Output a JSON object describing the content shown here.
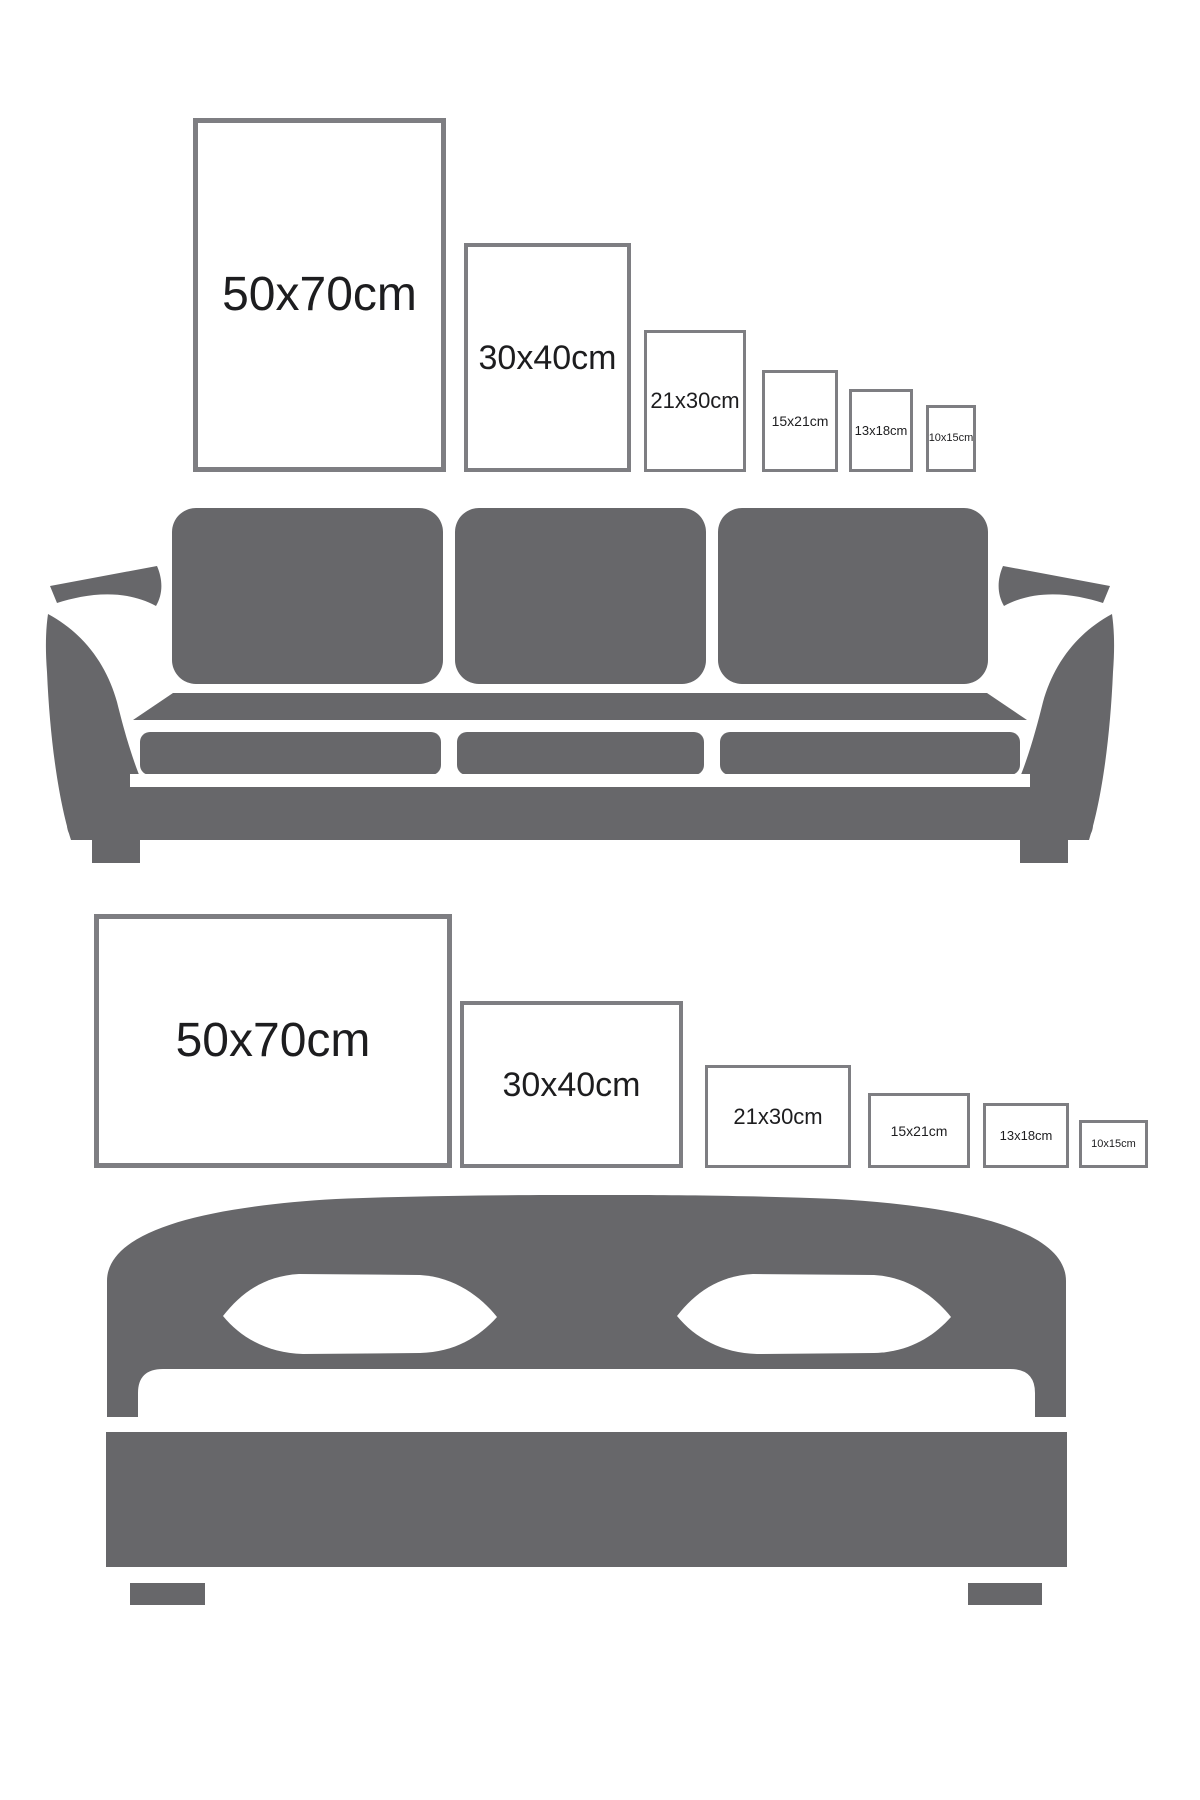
{
  "colors": {
    "background": "#ffffff",
    "furniture_gray": "#67676a",
    "frame_border": "#7e7e82",
    "label_text": "#1d1d1f"
  },
  "sections": [
    {
      "furniture": "sofa",
      "frame_orientation": "portrait",
      "frames": [
        {
          "label": "50x70cm"
        },
        {
          "label": "30x40cm"
        },
        {
          "label": "21x30cm"
        },
        {
          "label": "15x21cm"
        },
        {
          "label": "13x18cm"
        },
        {
          "label": "10x15cm"
        }
      ]
    },
    {
      "furniture": "bed",
      "frame_orientation": "landscape",
      "frames": [
        {
          "label": "50x70cm"
        },
        {
          "label": "30x40cm"
        },
        {
          "label": "21x30cm"
        },
        {
          "label": "15x21cm"
        },
        {
          "label": "13x18cm"
        },
        {
          "label": "10x15cm"
        }
      ]
    }
  ]
}
